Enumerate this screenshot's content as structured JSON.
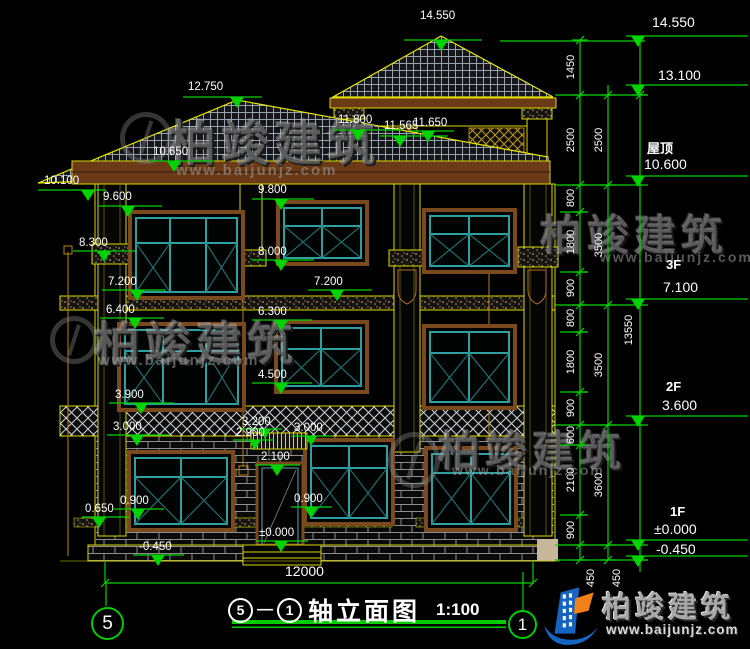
{
  "drawing": {
    "title_bar": {
      "axis_from": "5",
      "dash": "—",
      "axis_to": "1",
      "name": "轴立面图",
      "scale": "1:100"
    },
    "axis_bubbles": {
      "left": "5",
      "right": "1"
    },
    "overall_width": "12000",
    "total_height": "13550",
    "levels": [
      {
        "floor": "",
        "value": "14.550"
      },
      {
        "floor": "",
        "value": "13.100"
      },
      {
        "floor": "屋顶",
        "value": "10.600"
      },
      {
        "floor": "3F",
        "value": "7.100"
      },
      {
        "floor": "2F",
        "value": "3.600"
      },
      {
        "floor": "1F",
        "value": "±0.000"
      },
      {
        "floor": "",
        "value": "-0.450"
      }
    ],
    "chain_inner": [
      "1450",
      "2500",
      "800",
      "1800",
      "900",
      "800",
      "1800",
      "900",
      "600",
      "2100",
      "900",
      "450"
    ],
    "chain_outer": [
      "2500",
      "3500",
      "3500",
      "3600",
      "450"
    ],
    "markers": [
      "14.550",
      "12.750",
      "11.800",
      "11.565",
      "11.650",
      "10.650",
      "10.100",
      "9.600",
      "9.800",
      "8.300",
      "8.000",
      "7.200",
      "7.200",
      "6.400",
      "6.300",
      "4.500",
      "3.900",
      "3.000",
      "3.200",
      "2.900",
      "3.000",
      "2.100",
      "0.900",
      "0.900",
      "0.650",
      "±0.000",
      "-0.450"
    ]
  },
  "watermark": {
    "brand": "柏竣建筑",
    "url": "www.baijunjz.com"
  },
  "logo": {
    "brand": "柏竣建筑",
    "url": "www.baijunjz.com"
  },
  "colors": {
    "dim_green": "#00d400",
    "outline_yellow": "#e8e800",
    "window_teal": "#2fa0a0",
    "surround_brown": "#7a4a1e",
    "logo_blue": "#1565c0",
    "logo_orange": "#f08018"
  }
}
